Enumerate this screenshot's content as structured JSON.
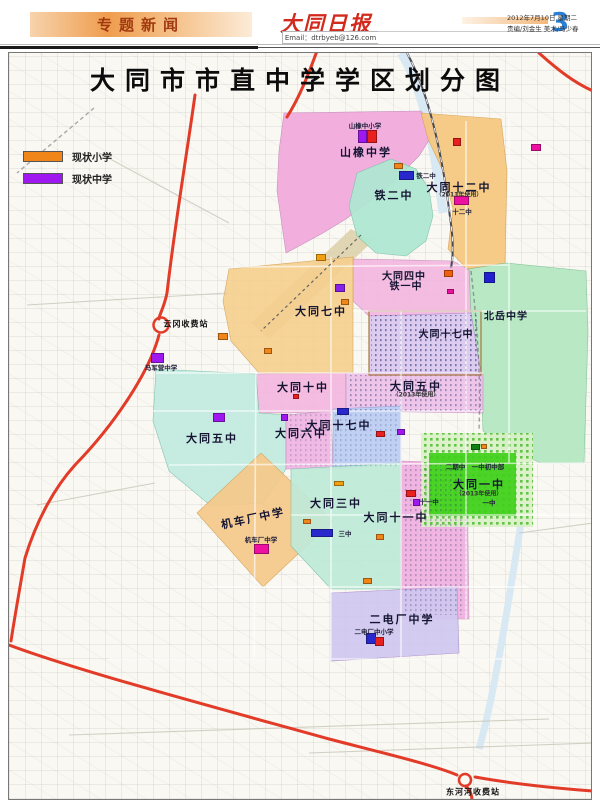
{
  "header": {
    "section_label": "专题新闻",
    "masthead": "大同日报",
    "email": "Email：dtrbyeb@126.com",
    "page_number": "3",
    "date_line": "2012年7月10日 星期二",
    "staff_line": "责编/刘金生  美术/马少春"
  },
  "map": {
    "title": "大同市市直中学学区划分图",
    "legend": {
      "primary_label": "现状小学",
      "primary_color": "#f08519",
      "middle_label": "现状中学",
      "middle_color": "#a018f0"
    },
    "district_labels": [
      {
        "t": "山橡中学"
      },
      {
        "t": "铁二中"
      },
      {
        "t": "大同十二中"
      },
      {
        "t": "大同四中"
      },
      {
        "t": "铁一中"
      },
      {
        "t": "大同七中"
      },
      {
        "t": "北岳中学"
      },
      {
        "t": "大同十七中"
      },
      {
        "t": "大同十中"
      },
      {
        "t": "大同五中"
      },
      {
        "t": "大同五中"
      },
      {
        "t": "大同六中"
      },
      {
        "t": "大同十七中"
      },
      {
        "t": "机车厂中学"
      },
      {
        "t": "大同三中"
      },
      {
        "t": "大同十一中"
      },
      {
        "t": "大同一中"
      },
      {
        "t": "二电厂中学"
      }
    ],
    "small_labels": [
      {
        "t": "山橡中小学"
      },
      {
        "t": "铁二中"
      },
      {
        "t": "十二中"
      },
      {
        "t": "（2013年使用）"
      },
      {
        "t": "（2013年使用）"
      },
      {
        "t": "机车厂中学"
      },
      {
        "t": "三中"
      },
      {
        "t": "十一中"
      },
      {
        "t": "二期中　一中初中部"
      },
      {
        "t": "（2013年使用）"
      },
      {
        "t": "一中"
      },
      {
        "t": "二电厂中小学"
      },
      {
        "t": "马军营中学"
      },
      {
        "t": "云冈收费站"
      },
      {
        "t": "东河河收费站"
      }
    ],
    "district_colors": {
      "shanxiang": "#f2a8dc",
      "tieerzhong": "#aee8d2",
      "shierzhong": "#f6c87e",
      "sizhong": "#f4b6e0",
      "qizhong": "#f6cf8e",
      "beiyue": "#b2e8c0",
      "oldcity": "#dcc8f0",
      "shizhong": "#f4b6e0",
      "wuzhong_e": "#eec0ea",
      "wuzhong_w": "#c2ece0",
      "liuzhong": "#f0b4e4",
      "shiqizhong": "#bccdf4",
      "jichechang": "#f5c98a",
      "sanzhong": "#bfead8",
      "shiyizhong": "#f0aede",
      "yizhong": "#3fd01a",
      "erdianchang": "#d0c8f0"
    },
    "road_color": "#e23b28",
    "markers": [
      {
        "x": 349,
        "y": 77,
        "w": 9,
        "h": 13,
        "c": "#a018f0"
      },
      {
        "x": 358,
        "y": 77,
        "w": 10,
        "h": 13,
        "c": "#e82020"
      },
      {
        "x": 385,
        "y": 110,
        "w": 9,
        "h": 6,
        "c": "#f08519"
      },
      {
        "x": 390,
        "y": 118,
        "w": 15,
        "h": 9,
        "c": "#2828cc"
      },
      {
        "x": 444,
        "y": 85,
        "w": 8,
        "h": 8,
        "c": "#e82020"
      },
      {
        "x": 522,
        "y": 91,
        "w": 10,
        "h": 7,
        "c": "#ee10a0"
      },
      {
        "x": 445,
        "y": 143,
        "w": 15,
        "h": 9,
        "c": "#ee10a0"
      },
      {
        "x": 307,
        "y": 201,
        "w": 10,
        "h": 7,
        "c": "#f0a010"
      },
      {
        "x": 326,
        "y": 231,
        "w": 10,
        "h": 8,
        "c": "#8820e8"
      },
      {
        "x": 332,
        "y": 246,
        "w": 8,
        "h": 6,
        "c": "#f08519"
      },
      {
        "x": 435,
        "y": 217,
        "w": 9,
        "h": 7,
        "c": "#f06010"
      },
      {
        "x": 438,
        "y": 236,
        "w": 7,
        "h": 5,
        "c": "#ee10a0"
      },
      {
        "x": 475,
        "y": 219,
        "w": 11,
        "h": 11,
        "c": "#2020d0"
      },
      {
        "x": 209,
        "y": 280,
        "w": 10,
        "h": 7,
        "c": "#f08519"
      },
      {
        "x": 255,
        "y": 295,
        "w": 8,
        "h": 6,
        "c": "#f08519"
      },
      {
        "x": 142,
        "y": 300,
        "w": 13,
        "h": 10,
        "c": "#a018f0"
      },
      {
        "x": 204,
        "y": 360,
        "w": 12,
        "h": 9,
        "c": "#a018f0"
      },
      {
        "x": 272,
        "y": 361,
        "w": 7,
        "h": 7,
        "c": "#a018f0"
      },
      {
        "x": 284,
        "y": 341,
        "w": 6,
        "h": 5,
        "c": "#e82020"
      },
      {
        "x": 328,
        "y": 355,
        "w": 12,
        "h": 7,
        "c": "#2828cc"
      },
      {
        "x": 388,
        "y": 376,
        "w": 8,
        "h": 6,
        "c": "#a018f0"
      },
      {
        "x": 367,
        "y": 378,
        "w": 9,
        "h": 6,
        "c": "#e82020"
      },
      {
        "x": 325,
        "y": 428,
        "w": 10,
        "h": 5,
        "c": "#f0a010"
      },
      {
        "x": 294,
        "y": 466,
        "w": 8,
        "h": 5,
        "c": "#f08519"
      },
      {
        "x": 302,
        "y": 476,
        "w": 22,
        "h": 8,
        "c": "#2828cc"
      },
      {
        "x": 245,
        "y": 491,
        "w": 15,
        "h": 10,
        "c": "#ee10a0"
      },
      {
        "x": 367,
        "y": 481,
        "w": 8,
        "h": 6,
        "c": "#f08519"
      },
      {
        "x": 397,
        "y": 437,
        "w": 10,
        "h": 7,
        "c": "#e82020"
      },
      {
        "x": 404,
        "y": 446,
        "w": 7,
        "h": 7,
        "c": "#a018f0"
      },
      {
        "x": 462,
        "y": 391,
        "w": 9,
        "h": 6,
        "c": "#108010"
      },
      {
        "x": 472,
        "y": 391,
        "w": 6,
        "h": 5,
        "c": "#f08519"
      },
      {
        "x": 357,
        "y": 580,
        "w": 10,
        "h": 11,
        "c": "#2828cc"
      },
      {
        "x": 366,
        "y": 584,
        "w": 9,
        "h": 9,
        "c": "#e82020"
      },
      {
        "x": 354,
        "y": 525,
        "w": 9,
        "h": 6,
        "c": "#f08519"
      }
    ]
  }
}
